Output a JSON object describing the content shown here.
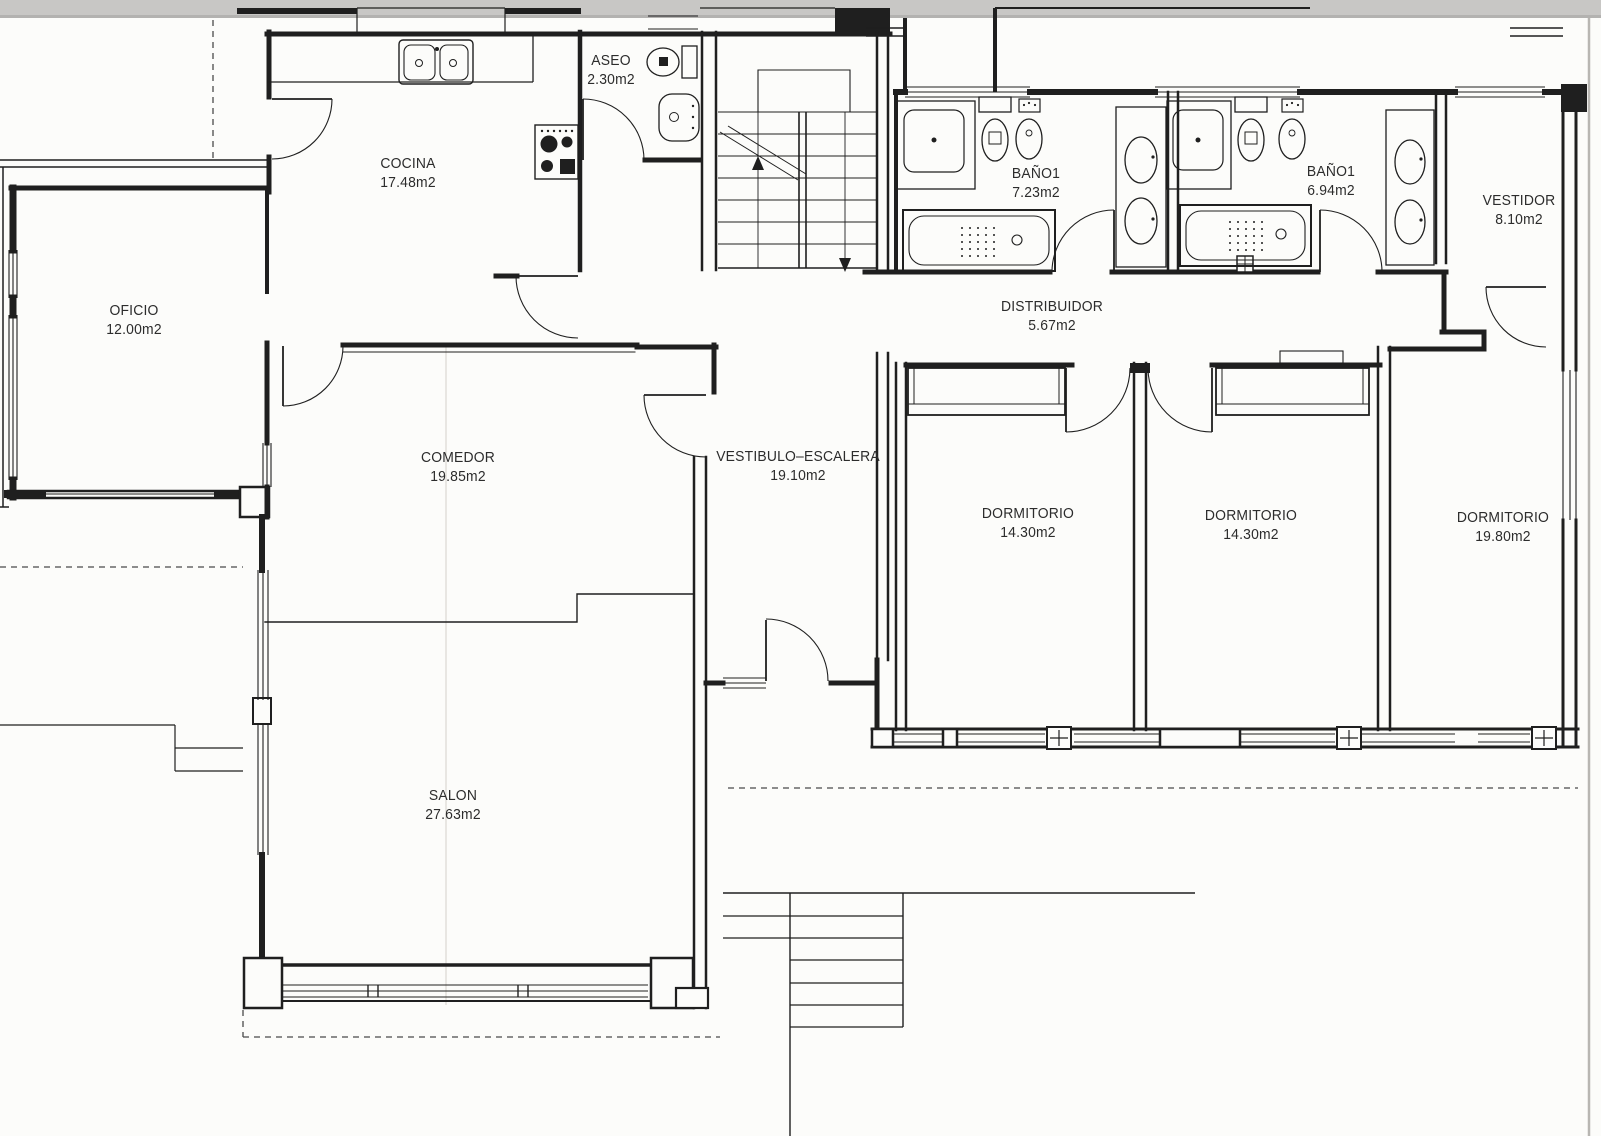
{
  "document": {
    "kind": "scanned architectural floor plan",
    "language": "Spanish",
    "units_suffix": "m2"
  },
  "colors": {
    "paper": "#fcfcfa",
    "ink": "#1f1f1f",
    "scan_strip": "#c8c7c5",
    "label_text": "#2c2c2c"
  },
  "rooms": [
    {
      "id": "cocina",
      "name": "COCINA",
      "area": "17.48m2"
    },
    {
      "id": "aseo",
      "name": "ASEO",
      "area": "2.30m2"
    },
    {
      "id": "oficio",
      "name": "OFICIO",
      "area": "12.00m2"
    },
    {
      "id": "comedor",
      "name": "COMEDOR",
      "area": "19.85m2"
    },
    {
      "id": "vestibulo",
      "name": "VESTIBULO–ESCALERA",
      "area": "19.10m2"
    },
    {
      "id": "salon",
      "name": "SALON",
      "area": "27.63m2"
    },
    {
      "id": "distribuidor",
      "name": "DISTRIBUIDOR",
      "area": "5.67m2"
    },
    {
      "id": "bano1-izq",
      "name": "BAÑO1",
      "area": "7.23m2"
    },
    {
      "id": "bano1-der",
      "name": "BAÑO1",
      "area": "6.94m2"
    },
    {
      "id": "vestidor",
      "name": "VESTIDOR",
      "area": "8.10m2"
    },
    {
      "id": "dormitorio-1",
      "name": "DORMITORIO",
      "area": "14.30m2"
    },
    {
      "id": "dormitorio-2",
      "name": "DORMITORIO",
      "area": "14.30m2"
    },
    {
      "id": "dormitorio-3",
      "name": "DORMITORIO",
      "area": "19.80m2"
    }
  ]
}
